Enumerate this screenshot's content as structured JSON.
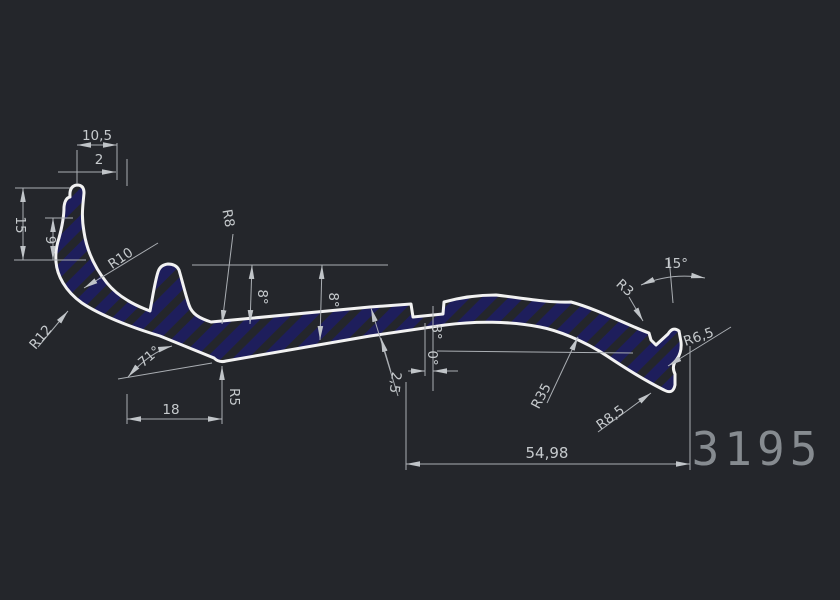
{
  "drawing": {
    "part_number": "3195",
    "colors": {
      "background": "#24262b",
      "profile_outline": "#f2f2f2",
      "hatch_fill": "#1e1e5c",
      "dimension_lines": "#aaaeb3",
      "dimension_text": "#c6cacd",
      "part_number_text": "#868b90"
    },
    "dimensions": {
      "top_width": "10,5",
      "top_wall": "2",
      "left_height": "15",
      "left_inner_height": "9",
      "radius_inner_left": "R10",
      "radius_outer_left": "R12",
      "angle_left": "71°",
      "bottom_left_width": "18",
      "radius_bottom_vertex": "R5",
      "radius_bump_fillet": "R8",
      "angle_top_first": "8°",
      "angle_top_second": "8°",
      "wall_thickness": "2,5",
      "angle_mid": "8°",
      "angle_notch": "0°",
      "radius_bottom_right": "R35",
      "radius_tail": "R8,5",
      "radius_fork": "R3",
      "angle_tip": "15°",
      "radius_right_edge": "R6,5",
      "overall_width": "54,98"
    }
  }
}
